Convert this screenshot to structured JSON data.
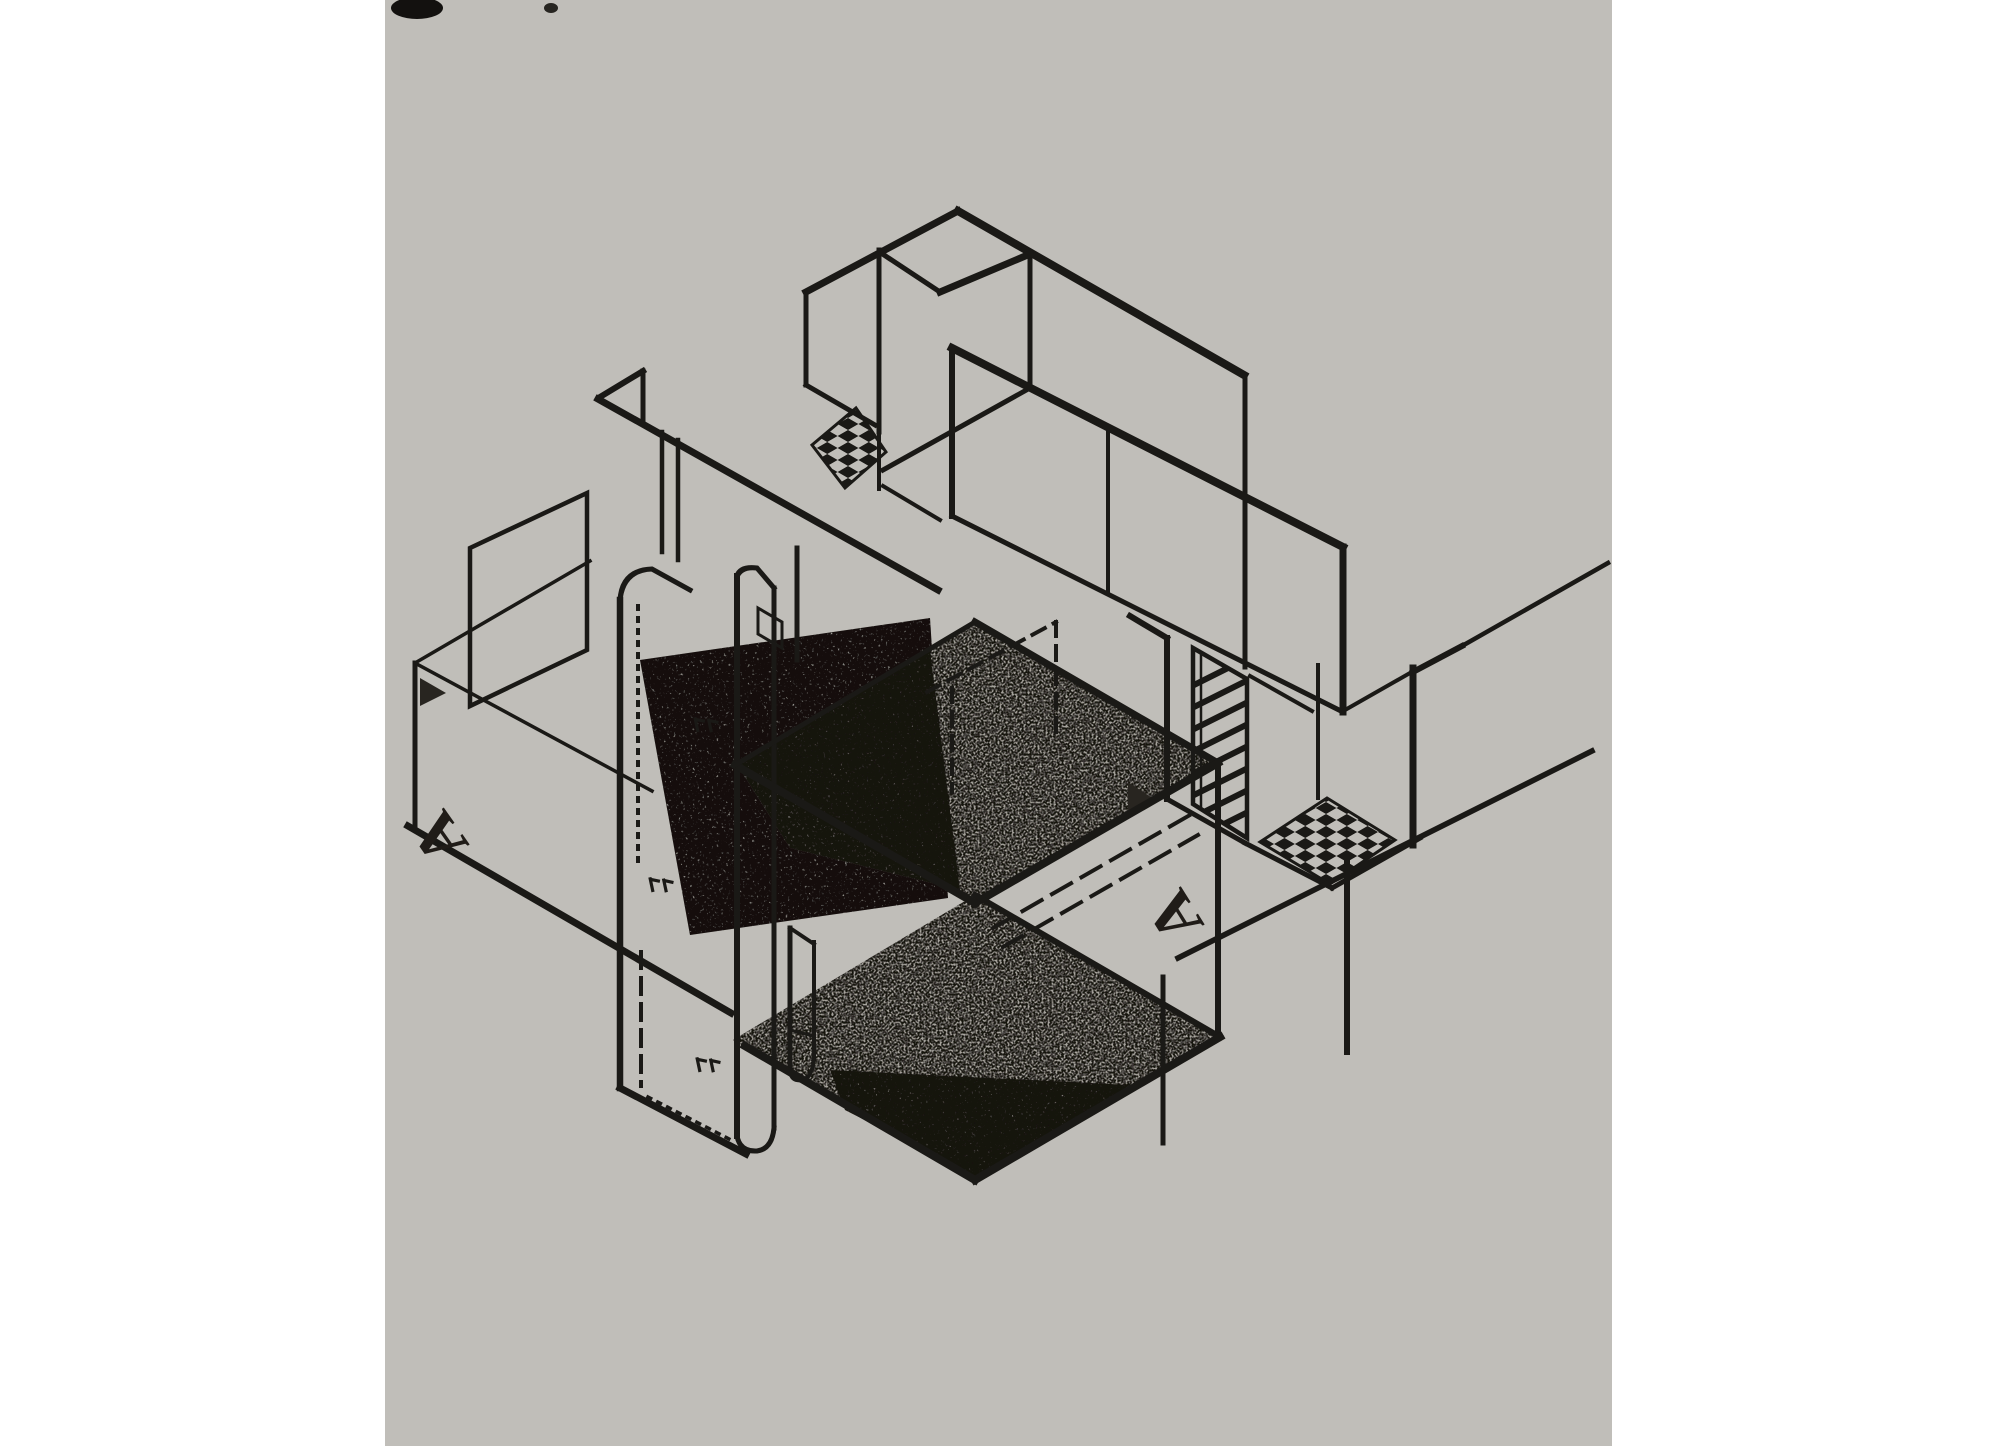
{
  "figure": {
    "title": "Axonometric architectural drawing",
    "description": "Scanned halftone print of an early-modernist (De Stijl style) axonometric projection of a house: free-standing wall planes, two stippled floor slabs at different levels, a central service core with rounded wall bands, a louvered door panel, two checkerboard floor patches and a section line marked A-A.",
    "projection": "axonometric, 30-degree axes",
    "media": "black ink on aged gray paper"
  },
  "labels": {
    "section_marker_left": "A",
    "section_marker_right": "A"
  },
  "colors": {
    "page_background": "#ffffff",
    "paper": "#d8d6d1",
    "ink": "#1c1a17",
    "slab_tone": "#b2afa8",
    "slab_shadow": "#58544e",
    "marker_ink": "#221e1a"
  },
  "patterns": {
    "floor_patch": "checkerboard",
    "door_panel": "diagonal-louvers",
    "floor_slabs": "stipple-halftone",
    "hidden_edges": "dashed",
    "core_texture": "dotted"
  },
  "annotations": {
    "plant_marks_count": 3,
    "checkerboard_patches_count": 2,
    "floor_slabs_count": 2
  }
}
